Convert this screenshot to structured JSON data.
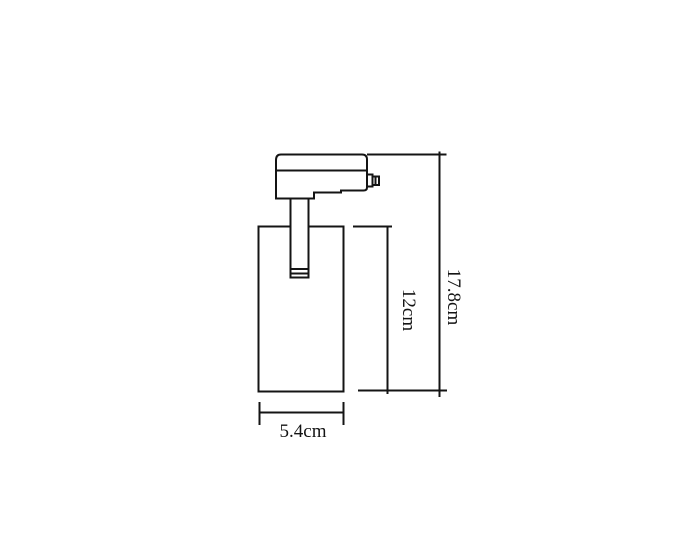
{
  "drawing": {
    "background": "#ffffff",
    "line_color": "#141414",
    "dimensions": {
      "overall_height": {
        "label": "17.8cm",
        "orientation": "vertical"
      },
      "body_height": {
        "label": "12cm",
        "orientation": "vertical"
      },
      "body_width": {
        "label": "5.4cm",
        "orientation": "horizontal"
      }
    }
  }
}
